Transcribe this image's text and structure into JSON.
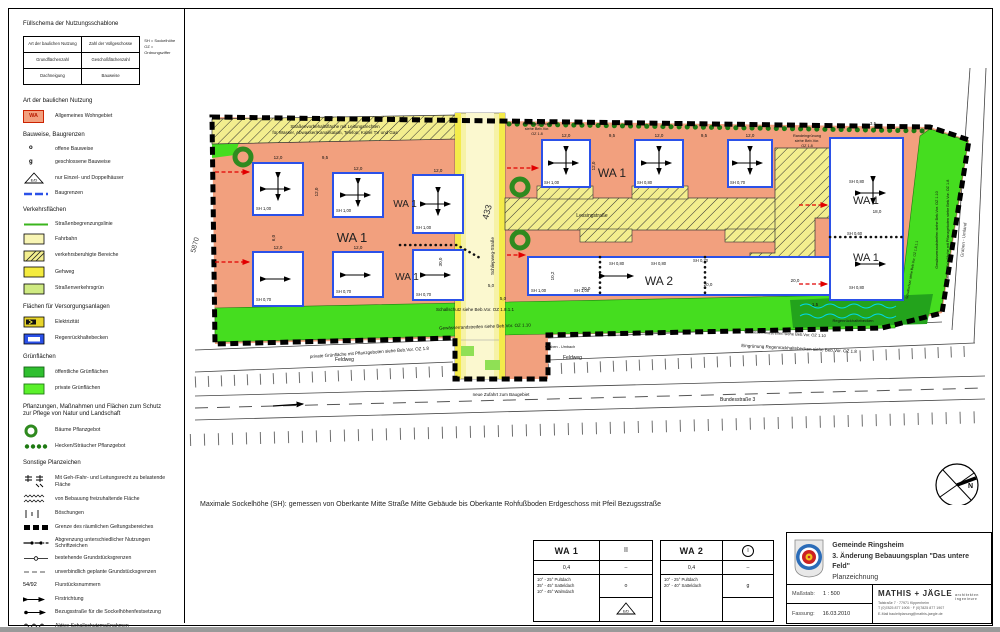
{
  "legend": {
    "title": "Füllschema der Nutzungsschablone",
    "schema": {
      "r1c1": "Art der baulichen Nutzung",
      "r1c2": "Zahl der Vollgeschosse",
      "r2c1": "Grundflächenzahl",
      "r2c2": "Geschoßflächenzahl",
      "r3c1": "Dachneigung",
      "r3c2": "Bauweise",
      "note1": "SH = Sockelhöhe",
      "note2": "OZ = Ordnungsziffer"
    },
    "art_heading": "Art der baulichen Nutzung",
    "wa_symbol": "WA",
    "wa_label": "Allgemeines Wohngebiet",
    "bauweise_heading": "Bauweise, Baugrenzen",
    "bw_o": "o",
    "bw_g": "g",
    "bw_items": [
      "offene Bauweise",
      "geschlossene Bauweise",
      "nur Einzel- und Doppelhäuser",
      "Baugrenzen"
    ],
    "verkehr_heading": "Verkehrsflächen",
    "verkehr_items": [
      "Straßenbegrenzungslinie",
      "Fahrbahn",
      "verkehrsberuhigte Bereiche",
      "Gehweg",
      "Straßenverkehrsgrün"
    ],
    "versorgung_heading": "Flächen für Versorgungsanlagen",
    "versorgung_items": [
      "Elektrizität",
      "Regenrückhaltebecken"
    ],
    "gruen_heading": "Grünflächen",
    "gruen_items": [
      "öffentliche Grünflächen",
      "private Grünflächen"
    ],
    "pflanz_heading1": "Pflanzungen, Maßnahmen und Flächen zum Schutz",
    "pflanz_heading2": "zur Pflege von Natur und Landschaft",
    "pflanz_items": [
      "Bäume Pflanzgebot",
      "Hecken/Sträucher Pflanzgebot"
    ],
    "sonstige_heading": "Sonstige Planzeichen",
    "sonstige_items": [
      "Mit Geh-/Fahr- und Leitungsrecht zu belastende Fläche",
      "von Bebauung freizuhaltende Fläche",
      "Böschungen",
      "Grenze des räumlichen Geltungsbereiches",
      "Abgrenzung unterschiedlicher Nutzungen Schriftzeichen",
      "bestehende Grundstücksgrenzen",
      "unverbindlich geplante Grundstücksgrenzen",
      "Flurstücksnummern",
      "Firstrichtung",
      "Bezugsstraße für die Sockelhöhenfestsetzung",
      "Aktive Schallschutzmaßnahmen"
    ],
    "flurstueck_sample": "54/92",
    "ed_label": "E/D"
  },
  "plan": {
    "vorbehalt1": "Straßenvorbehaltsfläche mit Leitungsrechten",
    "vorbehalt2": "für Wasser, Abwasser/Kanalisation, Telefon, Kabel TV und Gas",
    "wa1": "WA 1",
    "wa2": "WA 2",
    "lessing": "Lessingstraße",
    "street433": "433",
    "street_vert": "Schliepweg-Straße",
    "parcel5870": "5870",
    "schallschutz": "Schallschutz siehe Beb.Vor. OZ 1.8.1.1",
    "gewaesser": "Gewässerrandstreifen siehe Beb.Vor. OZ 1.10",
    "privgruen": "private Grünfläche mit Pflanzgeboten siehe Beb.Vor. OZ 1.8",
    "feldweg": "Feldweg",
    "graben_umbach": "Graben - Umbach",
    "graben_umland": "Graben - Umland",
    "zufahrt": "neue Zufahrt zum Baugebiet",
    "bundesstrasse": "Bundesstraße 3",
    "eingruenung_rrb": "Eingrünung Regenrückhaltebecken siehe Beb.Vor. OZ 1.8",
    "randein1": "Randeingrünung",
    "randein2": "siehe Beb.Vor.",
    "randein3": "OZ 1.8",
    "regenbecken": "Regenrückhaltebecken",
    "sh100": "SH 1,00",
    "sh080": "SH 0,80",
    "sh070": "SH 0,70",
    "sh060": "SH 0,60",
    "d120": "12,0",
    "d95": "9,5",
    "d200": "20,0",
    "d102": "10,2",
    "d180": "18,0",
    "d300": "30,0",
    "d50": "5,0",
    "d60": "6,0",
    "d15": "1,5",
    "d35": "3,5",
    "north": "N"
  },
  "note": "Maximale Sockelhöhe (SH): gemessen von Oberkante Mitte Straße Mitte Gebäude bis Oberkante Rohfußboden Erdgeschoss mit Pfeil Bezugsstraße",
  "tables": {
    "wa1": {
      "name": "WA 1",
      "floors": "II",
      "grz": "0,4",
      "gfz": "–",
      "dach": [
        "10° - 25° Pultdach",
        "35° - 45° Satteldach",
        "10° - 45° Walmdach"
      ],
      "bauweise": "o"
    },
    "wa2": {
      "name": "WA 2",
      "floors": "I",
      "grz": "0,4",
      "gfz": "–",
      "dach": [
        "10° - 25° Pultdach",
        "20° - 40° Satteldach"
      ],
      "bauweise": "g"
    },
    "ed_label": "E/D"
  },
  "titleblock": {
    "gemeinde": "Gemeinde Ringsheim",
    "plan": "3. Änderung Bebauungsplan \"Das untere Feld\"",
    "typ": "Planzeichnung",
    "masstab_label": "Maßstab:",
    "masstab": "1 : 500",
    "fassung_label": "Fassung:",
    "fassung": "16.03.2010",
    "firma": "MATHIS + JÄGLE",
    "firma_sub": "architekten ingenieure",
    "addr1": "Talstraße 7 · 77971 Kippenheim",
    "addr2": "T (0)7825 877 1905 · F (0)7825 877 1907",
    "addr3": "E-Mail bauleitplanung@mathis-jaegle.de"
  },
  "colors": {
    "wohngebiet_salmon": "#F2A07E",
    "road_yellow": "#F4EB4A",
    "road_pale": "#F8F5B4",
    "hatch_yellow": "#F3EE8E",
    "green_private": "#45DD1F",
    "green_public": "#23A31C",
    "baugrenze_blue": "#2B51E8",
    "bezug_red": "#E10000"
  }
}
